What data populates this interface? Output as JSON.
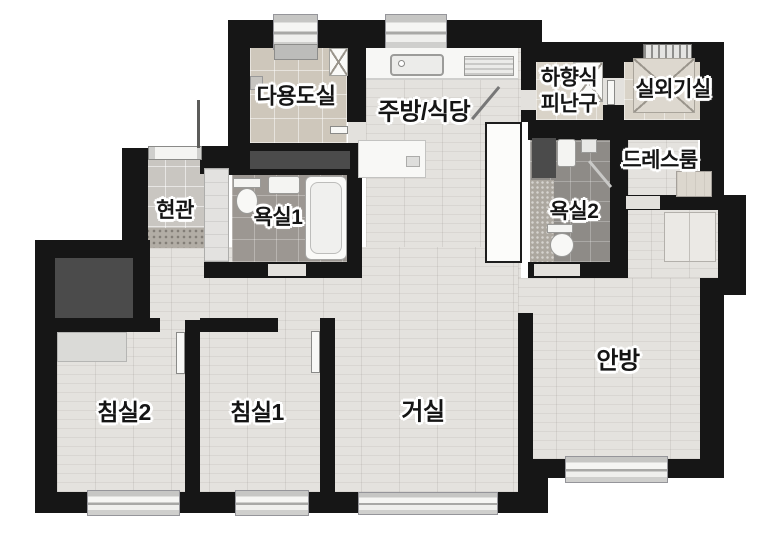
{
  "plan": {
    "labels": [
      {
        "key": "utility",
        "text": "다용도실"
      },
      {
        "key": "kitchen",
        "text": "주방/식당"
      },
      {
        "key": "hatch",
        "text": "하향식\n피난구"
      },
      {
        "key": "outdoor-unit",
        "text": "실외기실"
      },
      {
        "key": "dressroom",
        "text": "드레스룸"
      },
      {
        "key": "entrance",
        "text": "현관"
      },
      {
        "key": "bath1",
        "text": "욕실1"
      },
      {
        "key": "bath2",
        "text": "욕실2"
      },
      {
        "key": "bedroom2",
        "text": "침실2"
      },
      {
        "key": "bedroom1",
        "text": "침실1"
      },
      {
        "key": "living",
        "text": "거실"
      },
      {
        "key": "master",
        "text": "안방"
      }
    ],
    "palette": {
      "wall": "#161616",
      "wood_floor": "#e4e2de",
      "beige_tile": "#cec7bb",
      "bath_tile": "#9c9792",
      "entry_tile": "#c9c6c1",
      "dark_inset": "#4b4b4b",
      "background": "#ffffff"
    }
  }
}
